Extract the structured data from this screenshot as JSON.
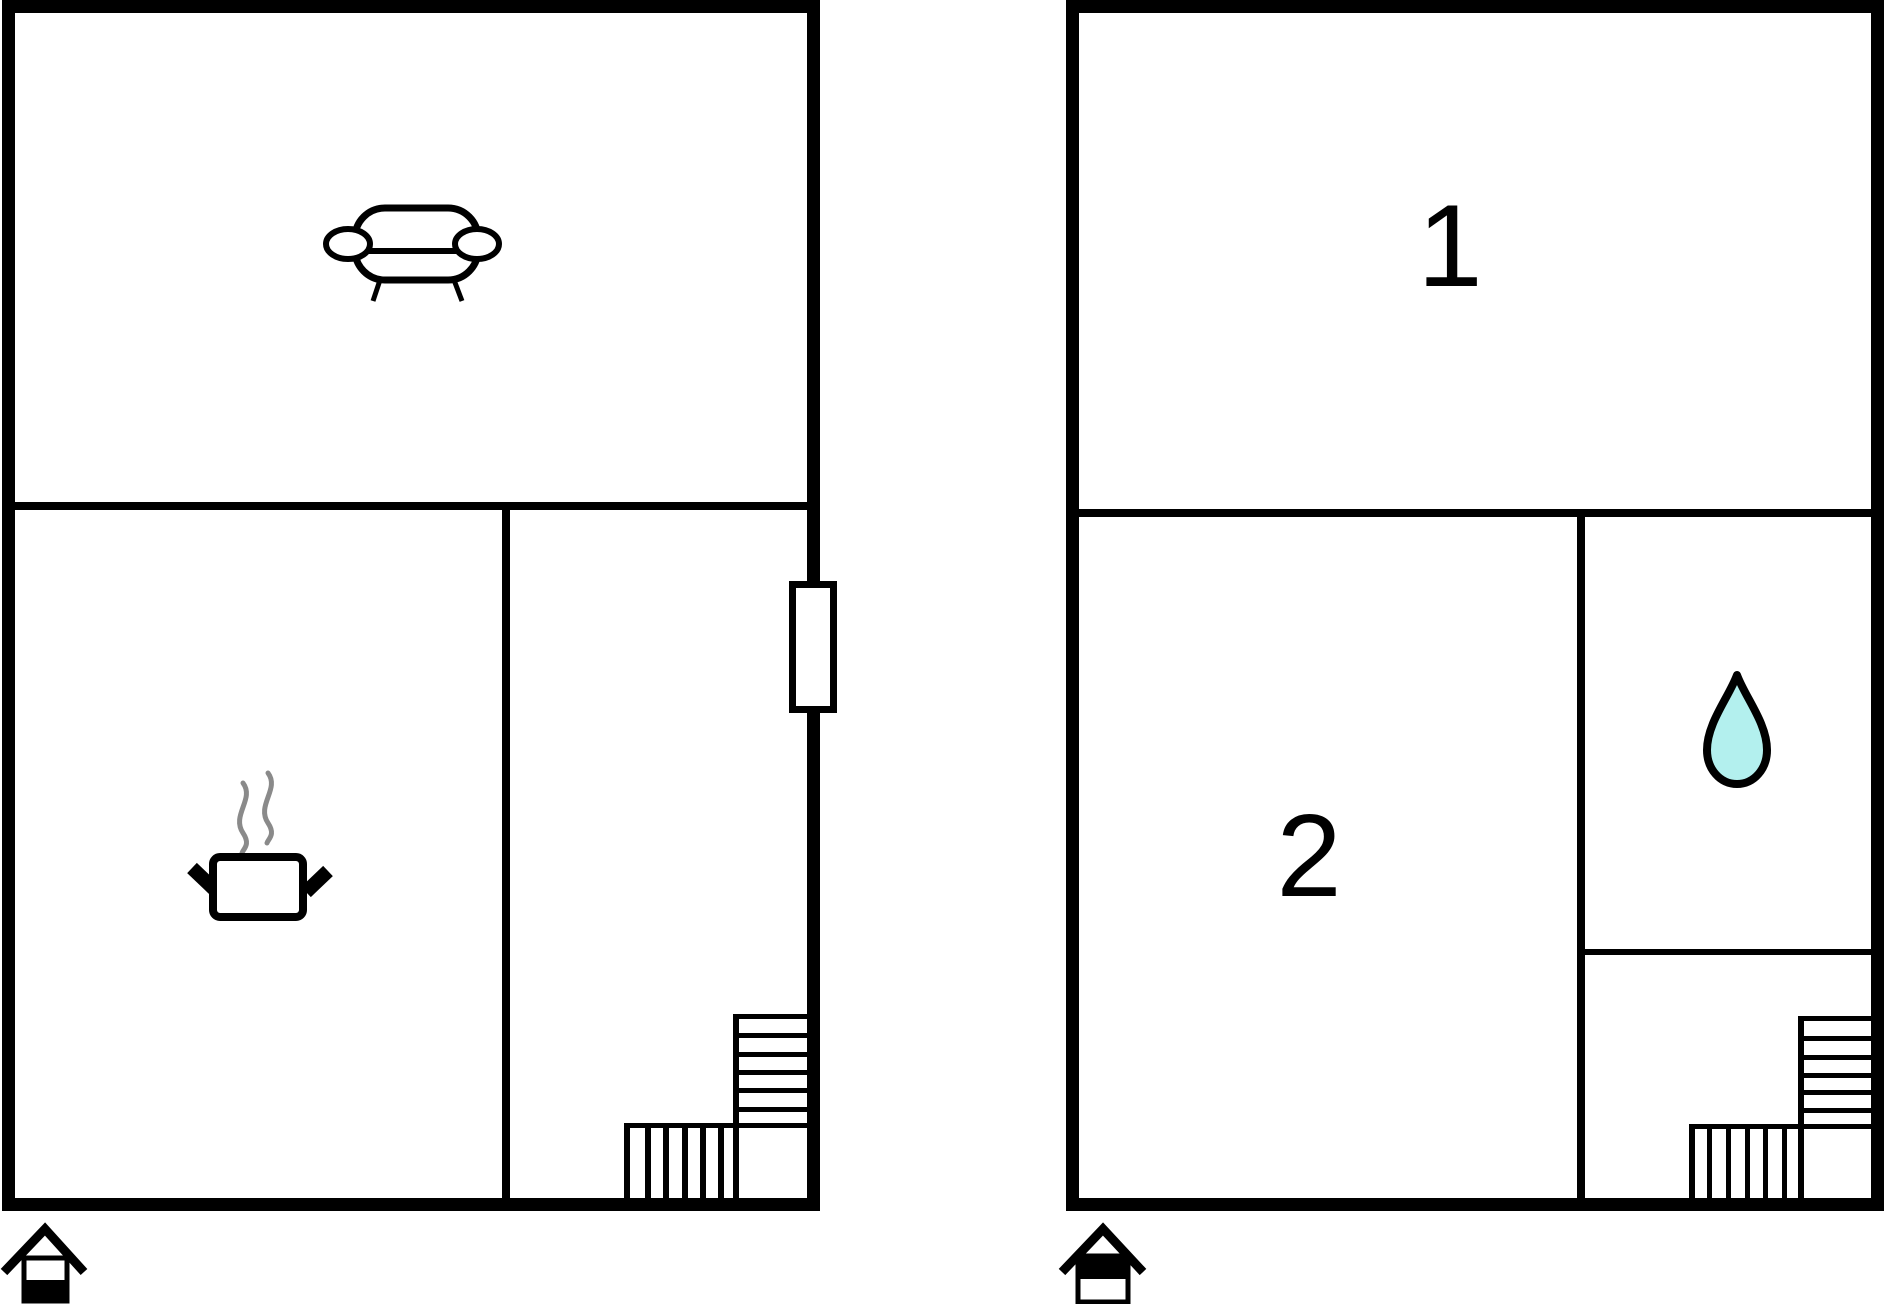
{
  "colors": {
    "wall": "#000000",
    "background": "#ffffff",
    "water_drop_fill": "#b3f0ee",
    "steam": "#8a8a8a"
  },
  "ground_floor": {
    "indicator_icon": "house-ground-floor-icon",
    "icons": [
      "sofa-icon",
      "cooking-pot-icon",
      "steam-icon",
      "window-marker",
      "staircase"
    ],
    "room_labels": {}
  },
  "upper_floor": {
    "indicator_icon": "house-upper-floor-icon",
    "icons": [
      "water-drop-icon",
      "staircase"
    ],
    "room_labels": {
      "room_1": "1",
      "room_2": "2"
    }
  }
}
